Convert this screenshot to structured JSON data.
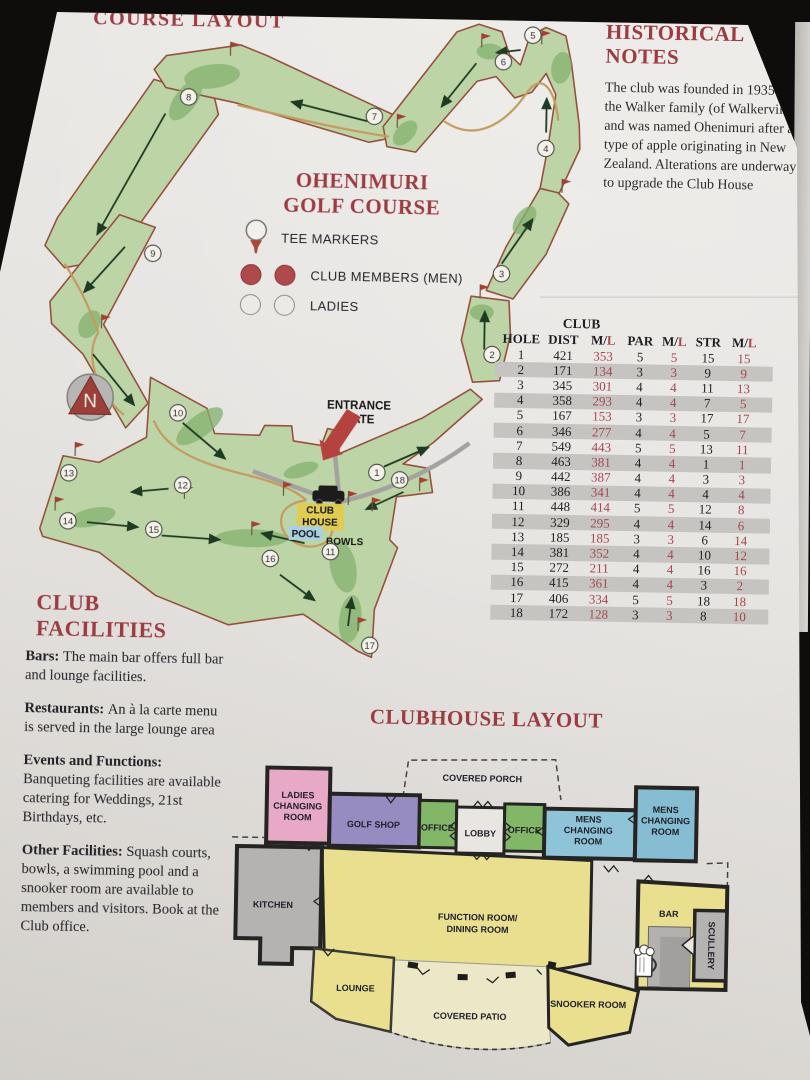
{
  "colors": {
    "heading_red": "#9c3b41",
    "ladies_red": "#a4484e",
    "fairway_green": "#bdd5a6",
    "dark_green": "#85b271",
    "plan_yellow": "#eadf8e",
    "plan_pink": "#e7a9c5",
    "plan_purple": "#968cc2",
    "plan_blue": "#8fc4d8",
    "plan_green": "#82b768"
  },
  "course_layout_title": "COURSE LAYOUT",
  "historical": {
    "title_line1": "HISTORICAL",
    "title_line2": "NOTES",
    "body": "The club was founded in 1935 by the Walker family (of Walkerville) and was named Ohenimuri after a type of apple originating in New Zealand. Alterations are underway to upgrade the Club House"
  },
  "map": {
    "title_line1": "OHENIMURI",
    "title_line2": "GOLF COURSE",
    "legend": {
      "tee": "TEE MARKERS",
      "men": "CLUB MEMBERS (MEN)",
      "ladies": "LADIES"
    },
    "compass_n": "N",
    "entrance_line1": "ENTRANCE",
    "entrance_line2": "GATE",
    "club_house_line1": "CLUB",
    "club_house_line2": "HOUSE",
    "pool": "POOL",
    "bowls": "BOWLS",
    "holes": [
      {
        "n": "1",
        "x": 376,
        "y": 473
      },
      {
        "n": "2",
        "x": 489,
        "y": 353
      },
      {
        "n": "3",
        "x": 497,
        "y": 272
      },
      {
        "n": "4",
        "x": 539,
        "y": 146
      },
      {
        "n": "5",
        "x": 524,
        "y": 33
      },
      {
        "n": "6",
        "x": 495,
        "y": 60
      },
      {
        "n": "7",
        "x": 367,
        "y": 117
      },
      {
        "n": "8",
        "x": 181,
        "y": 101
      },
      {
        "n": "9",
        "x": 148,
        "y": 258
      },
      {
        "n": "10",
        "x": 176,
        "y": 417
      },
      {
        "n": "11",
        "x": 331,
        "y": 553
      },
      {
        "n": "12",
        "x": 182,
        "y": 489
      },
      {
        "n": "13",
        "x": 68,
        "y": 479
      },
      {
        "n": "14",
        "x": 68,
        "y": 527
      },
      {
        "n": "15",
        "x": 154,
        "y": 534
      },
      {
        "n": "16",
        "x": 271,
        "y": 561
      },
      {
        "n": "17",
        "x": 372,
        "y": 646
      },
      {
        "n": "18",
        "x": 399,
        "y": 480
      }
    ]
  },
  "score_table": {
    "group_header": "CLUB",
    "headers": [
      "HOLE",
      "DIST",
      "M/L",
      "PAR",
      "M/L",
      "STR",
      "M/L"
    ],
    "rows": [
      [
        1,
        421,
        353,
        5,
        5,
        15,
        15
      ],
      [
        2,
        171,
        134,
        3,
        3,
        9,
        9
      ],
      [
        3,
        345,
        301,
        4,
        4,
        11,
        13
      ],
      [
        4,
        358,
        293,
        4,
        4,
        7,
        5
      ],
      [
        5,
        167,
        153,
        3,
        3,
        17,
        17
      ],
      [
        6,
        346,
        277,
        4,
        4,
        5,
        7
      ],
      [
        7,
        549,
        443,
        5,
        5,
        13,
        11
      ],
      [
        8,
        463,
        381,
        4,
        4,
        1,
        1
      ],
      [
        9,
        442,
        387,
        4,
        4,
        3,
        3
      ],
      [
        10,
        386,
        341,
        4,
        4,
        4,
        4
      ],
      [
        11,
        448,
        414,
        5,
        5,
        12,
        8
      ],
      [
        12,
        329,
        295,
        4,
        4,
        14,
        6
      ],
      [
        13,
        185,
        185,
        3,
        3,
        6,
        14
      ],
      [
        14,
        381,
        352,
        4,
        4,
        10,
        12
      ],
      [
        15,
        272,
        211,
        4,
        4,
        16,
        16
      ],
      [
        16,
        415,
        361,
        4,
        4,
        3,
        2
      ],
      [
        17,
        406,
        334,
        5,
        5,
        18,
        18
      ],
      [
        18,
        172,
        128,
        3,
        3,
        8,
        10
      ]
    ]
  },
  "facilities": {
    "title": "CLUB FACILITIES",
    "sections": [
      {
        "lead": "Bars:",
        "text": "The main bar offers full bar and lounge facilities."
      },
      {
        "lead": "Restaurants:",
        "text": "An à la carte menu is served in the large lounge area"
      },
      {
        "lead": "Events and Functions:",
        "text": "Banqueting facilities are available catering for Weddings, 21st Birthdays, etc."
      },
      {
        "lead": "Other Facilities:",
        "text": "Squash courts, bowls, a swimming pool and a snooker room are available to members and visitors. Book at the Club office."
      }
    ]
  },
  "clubhouse": {
    "title": "CLUBHOUSE LAYOUT",
    "rooms": {
      "covered_porch": "COVERED PORCH",
      "ladies": [
        "LADIES",
        "CHANGING",
        "ROOM"
      ],
      "golf_shop": "GOLF SHOP",
      "office1": "OFFICE",
      "lobby": "LOBBY",
      "office2": "OFFICE",
      "mens1": [
        "MENS",
        "CHANGING",
        "ROOM"
      ],
      "mens2": [
        "MENS",
        "CHANGING",
        "ROOM"
      ],
      "kitchen": "KITCHEN",
      "function": [
        "FUNCTION ROOM/",
        "DINING ROOM"
      ],
      "lounge": "LOUNGE",
      "covered_patio": "COVERED PATIO",
      "snooker": "SNOOKER ROOM",
      "bar": "BAR",
      "scullery": "SCULLERY"
    }
  }
}
